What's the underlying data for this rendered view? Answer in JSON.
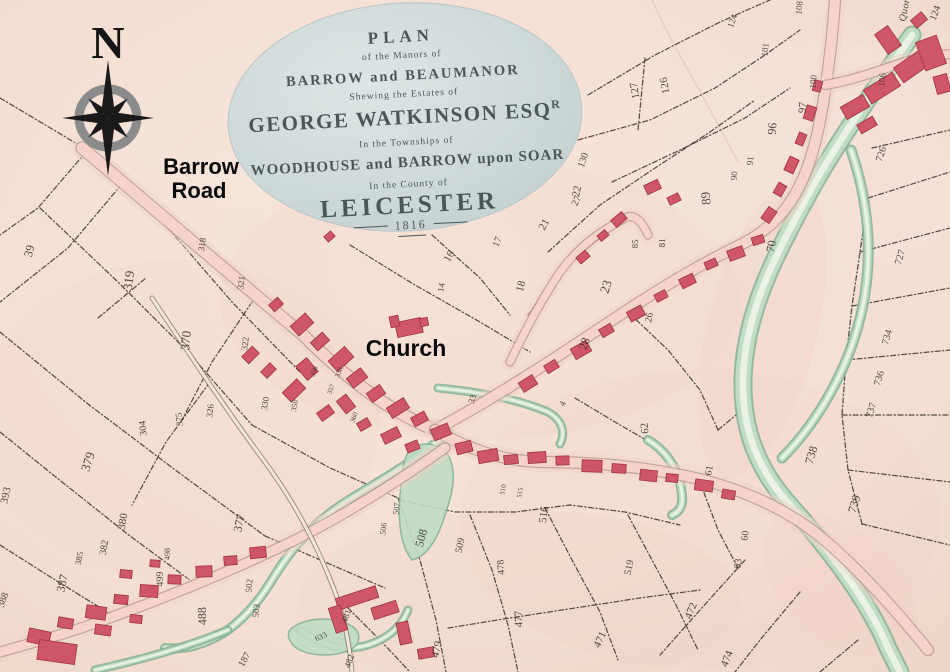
{
  "cartouche": {
    "plan": "PLAN",
    "of_manors": "of the Manors of",
    "barrow_beaumanor": "BARROW and BEAUMANOR",
    "shewing": "Shewing the Estates of",
    "owner": "GEORGE WATKINSON ESQ",
    "owner_sup": "R",
    "townships": "In the Townships of",
    "woodhouse_line": "WOODHOUSE and BARROW upon SOAR",
    "county": "In the County of",
    "leicester": "LEICESTER",
    "year": "1816"
  },
  "annotations": {
    "north": "N",
    "road_line1": "Barrow",
    "road_line2": "Road",
    "church": "Church",
    "quorn": "Quorn"
  },
  "colors": {
    "paper": "#f4e0d6",
    "road_fill": "#f5d3ca",
    "road_edge": "#b2938a",
    "lane_fill": "#f3e6da",
    "lane_edge": "#7c6c60",
    "building": "#cf5666",
    "building_edge": "#9e3344",
    "water_dark": "#85b296",
    "water_mid": "#c0dcc5",
    "water_light": "#e9f2e4",
    "boundary": "#332d26",
    "cartouche_fill": "#ccd8d9",
    "cartouche_text": "#4b565a",
    "compass_gray": "#8b8b8b",
    "label": "#0a0a0a"
  },
  "waterways": [
    {
      "d": "M912,35 C878,85 838,140 808,195 C778,250 752,300 745,355 C738,408 748,458 788,503 C830,550 868,600 888,648 C895,662 898,668 900,672",
      "w": 15
    },
    {
      "d": "M851,150 C868,200 874,255 862,310 C850,365 820,420 782,458",
      "w": 7
    },
    {
      "d": "M448,432 C420,458 385,478 352,498 C315,520 292,548 275,575 C262,597 248,615 228,630 C205,645 185,650 165,648",
      "w": 6
    },
    {
      "d": "M95,670 C140,660 185,648 228,630",
      "w": 5
    },
    {
      "d": "M438,388 C480,392 520,400 548,412 C562,420 566,432 560,444",
      "w": 5
    },
    {
      "d": "M648,440 C668,452 680,472 682,495 C683,505 680,512 672,515",
      "w": 6
    },
    {
      "d": "M300,630 C320,645 345,652 368,645 C390,638 402,625 408,610",
      "w": 5
    }
  ],
  "water_areas": [
    {
      "d": "M408,452 C420,440 438,442 448,455 C458,472 452,495 445,515 C438,538 428,556 412,560 C400,545 398,520 400,495 C402,475 402,465 408,452 Z"
    },
    {
      "d": "M292,628 C305,618 330,616 348,624 C362,630 362,644 350,650 C332,658 305,656 294,646 C288,640 286,633 292,628 Z"
    }
  ],
  "roads": [
    {
      "d": "M82,148 C150,205 225,270 302,334 C340,372 385,410 435,430",
      "w": 11
    },
    {
      "d": "M435,430 C500,395 560,355 620,315 C665,285 705,262 740,245 C770,230 788,210 800,185 C815,155 822,115 828,70 C832,40 834,15 835,0",
      "w": 10
    },
    {
      "d": "M825,85 C855,80 880,70 905,62 C925,57 940,55 950,54",
      "w": 8
    },
    {
      "d": "M510,362 C530,320 545,295 560,272 C580,245 600,232 625,218 C635,212 644,225 648,235",
      "w": 7
    },
    {
      "d": "M435,430 C470,450 505,462 545,462 C600,462 650,468 695,478 C745,490 788,510 822,538 C860,570 900,615 928,650",
      "w": 10
    },
    {
      "d": "M445,448 C400,480 350,512 295,540 C230,572 160,600 90,625 C55,637 25,645 0,652",
      "w": 9
    }
  ],
  "lanes": [
    {
      "d": "M152,298 C190,355 225,408 262,458 C295,502 320,550 338,600 C346,625 350,650 352,672",
      "w": 3
    }
  ],
  "boundaries": [
    "0,98 84,148",
    "86,152 38,208 0,235",
    "122,184 68,248 0,302",
    "40,208 118,282 188,352 252,425",
    "168,228 232,302 300,372",
    "0,332 88,404 178,472 265,536",
    "0,432 62,482 130,536 198,586",
    "0,545 52,578 112,615",
    "252,425 330,468 398,498",
    "265,536 325,562 385,588",
    "210,382 166,442 132,505",
    "252,302 212,362 182,420",
    "98,318 146,278",
    "588,95 655,55 720,22 770,0",
    "578,140 650,120 715,88 765,55 800,30",
    "612,182 680,150 745,118 790,88",
    "548,252 600,205 655,168 710,132 755,100",
    "528,315 560,270 600,238",
    "645,58 638,130",
    "628,312 668,350 700,390 718,430",
    "718,430 748,405",
    "575,398 620,425 660,448",
    "432,235 480,278 510,315",
    "350,245 415,285 480,322 530,352",
    "872,148 950,130",
    "868,198 950,172",
    "860,252 950,228",
    "852,306 950,288",
    "846,360 950,350",
    "842,415 950,415",
    "848,470 950,482",
    "862,524 950,545",
    "868,198 860,252 852,306 846,360 842,415 848,470 862,524",
    "745,560 700,610 660,655",
    "800,592 760,640 735,672",
    "858,640 820,672",
    "400,500 455,512 515,512 570,505 625,512 680,525",
    "398,498 420,560 436,620 446,672",
    "470,515 492,570 508,625 518,672",
    "545,508 572,560 600,612 618,660",
    "628,515 652,560 676,605 698,650",
    "700,482 718,530 738,568",
    "448,628 510,618 575,608 640,598 700,590",
    "340,600 380,640 410,672"
  ],
  "parcels": [
    [
      "39",
      33,
      252,
      -75,
      12
    ],
    [
      "319",
      133,
      281,
      -83,
      13
    ],
    [
      "318",
      205,
      245,
      -80,
      9
    ],
    [
      "370",
      190,
      341,
      -84,
      13
    ],
    [
      "321",
      244,
      283,
      -83,
      9
    ],
    [
      "304",
      146,
      428,
      -95,
      10
    ],
    [
      "375",
      182,
      419,
      -95,
      9
    ],
    [
      "322",
      248,
      344,
      -83,
      9
    ],
    [
      "326",
      213,
      411,
      -85,
      9
    ],
    [
      "330",
      268,
      404,
      -80,
      9
    ],
    [
      "379",
      92,
      463,
      -72,
      13
    ],
    [
      "393",
      9,
      496,
      -78,
      11
    ],
    [
      "388",
      6,
      601,
      -70,
      10
    ],
    [
      "387",
      66,
      584,
      -78,
      12
    ],
    [
      "385",
      82,
      559,
      -78,
      9
    ],
    [
      "382",
      107,
      548,
      -80,
      10
    ],
    [
      "380",
      126,
      522,
      -80,
      11
    ],
    [
      "377",
      243,
      524,
      -76,
      12
    ],
    [
      "498",
      170,
      554,
      -90,
      8
    ],
    [
      "499",
      163,
      579,
      -92,
      10
    ],
    [
      "488",
      206,
      616,
      -92,
      12
    ],
    [
      "502",
      252,
      586,
      -85,
      9
    ],
    [
      "503",
      259,
      611,
      -85,
      9
    ],
    [
      "187",
      247,
      661,
      -60,
      10
    ],
    [
      "633",
      322,
      639,
      -25,
      8
    ],
    [
      "481",
      349,
      617,
      -72,
      9
    ],
    [
      "482",
      352,
      662,
      -72,
      9
    ],
    [
      "479",
      440,
      650,
      -78,
      11
    ],
    [
      "477",
      522,
      619,
      -92,
      11
    ],
    [
      "478",
      504,
      567,
      -95,
      10
    ],
    [
      "471",
      603,
      641,
      -65,
      11
    ],
    [
      "474",
      730,
      660,
      -68,
      11
    ],
    [
      "472",
      694,
      612,
      -68,
      11
    ],
    [
      "508",
      425,
      539,
      -75,
      12
    ],
    [
      "509",
      463,
      546,
      -78,
      10
    ],
    [
      "506",
      386,
      529,
      -83,
      8
    ],
    [
      "507",
      399,
      509,
      -83,
      8
    ],
    [
      "516",
      547,
      515,
      -83,
      11
    ],
    [
      "519",
      632,
      568,
      -78,
      10
    ],
    [
      "62",
      648,
      428,
      -95,
      11
    ],
    [
      "63",
      741,
      564,
      -83,
      10
    ],
    [
      "60",
      748,
      536,
      -83,
      10
    ],
    [
      "61",
      712,
      471,
      -80,
      10
    ],
    [
      "738",
      815,
      456,
      -74,
      12
    ],
    [
      "739",
      858,
      505,
      -74,
      12
    ],
    [
      "736",
      882,
      379,
      -74,
      10
    ],
    [
      "737",
      874,
      411,
      -74,
      10
    ],
    [
      "734",
      890,
      338,
      -74,
      10
    ],
    [
      "727",
      903,
      258,
      -74,
      10
    ],
    [
      "726",
      884,
      155,
      -72,
      10
    ],
    [
      "70",
      775,
      247,
      -80,
      12
    ],
    [
      "89",
      710,
      198,
      -95,
      13
    ],
    [
      "96",
      776,
      129,
      -85,
      12
    ],
    [
      "97",
      806,
      108,
      -85,
      11
    ],
    [
      "91",
      753,
      161,
      -85,
      9
    ],
    [
      "90",
      737,
      176,
      -85,
      9
    ],
    [
      "100",
      816,
      82,
      -85,
      9
    ],
    [
      "101",
      768,
      50,
      -85,
      9
    ],
    [
      "108",
      802,
      8,
      -85,
      9
    ],
    [
      "106",
      885,
      80,
      -85,
      9
    ],
    [
      "124",
      938,
      14,
      -70,
      10
    ],
    [
      "124",
      735,
      22,
      -70,
      9
    ],
    [
      "127",
      638,
      90,
      -100,
      11
    ],
    [
      "126",
      668,
      85,
      -100,
      11
    ],
    [
      "128",
      572,
      80,
      -85,
      9
    ],
    [
      "130",
      586,
      161,
      -72,
      10
    ],
    [
      "22",
      580,
      192,
      -78,
      11
    ],
    [
      "23",
      610,
      288,
      -72,
      13
    ],
    [
      "81",
      665,
      243,
      -88,
      9
    ],
    [
      "85",
      638,
      244,
      -88,
      9
    ],
    [
      "26",
      652,
      318,
      -80,
      10
    ],
    [
      "16",
      452,
      258,
      -60,
      11
    ],
    [
      "17",
      500,
      243,
      -68,
      10
    ],
    [
      "21",
      547,
      226,
      -62,
      11
    ],
    [
      "27",
      579,
      202,
      -65,
      10
    ],
    [
      "18",
      524,
      287,
      -75,
      11
    ],
    [
      "28",
      588,
      345,
      -70,
      12
    ],
    [
      "14",
      444,
      288,
      -80,
      9
    ],
    [
      "33",
      475,
      400,
      -70,
      9
    ],
    [
      "4",
      565,
      405,
      -60,
      9
    ],
    [
      "357",
      333,
      390,
      -70,
      7
    ],
    [
      "338",
      341,
      373,
      -70,
      7
    ],
    [
      "356",
      316,
      372,
      -70,
      7
    ],
    [
      "360",
      356,
      418,
      -70,
      7
    ],
    [
      "350",
      297,
      406,
      -78,
      8
    ],
    [
      "510",
      505,
      490,
      -80,
      7
    ],
    [
      "515",
      522,
      493,
      -80,
      7
    ]
  ],
  "buildings": [
    [
      292,
      318,
      20,
      13,
      -42
    ],
    [
      312,
      336,
      16,
      11,
      -42
    ],
    [
      270,
      300,
      12,
      9,
      -42
    ],
    [
      330,
      352,
      22,
      14,
      -42
    ],
    [
      300,
      360,
      14,
      18,
      -40
    ],
    [
      348,
      372,
      18,
      12,
      -38
    ],
    [
      368,
      388,
      16,
      11,
      -35
    ],
    [
      340,
      396,
      12,
      16,
      -38
    ],
    [
      388,
      402,
      20,
      12,
      -32
    ],
    [
      412,
      414,
      15,
      10,
      -28
    ],
    [
      432,
      426,
      18,
      12,
      -22
    ],
    [
      284,
      384,
      20,
      13,
      -44
    ],
    [
      262,
      366,
      13,
      9,
      -45
    ],
    [
      243,
      350,
      15,
      10,
      -45
    ],
    [
      318,
      408,
      15,
      10,
      -36
    ],
    [
      358,
      420,
      12,
      9,
      -30
    ],
    [
      382,
      430,
      18,
      11,
      -26
    ],
    [
      406,
      442,
      13,
      9,
      -22
    ],
    [
      396,
      320,
      26,
      15,
      -12
    ],
    [
      390,
      316,
      9,
      11,
      -12
    ],
    [
      420,
      318,
      8,
      8,
      -12
    ],
    [
      456,
      442,
      16,
      11,
      -14
    ],
    [
      478,
      450,
      20,
      12,
      -10
    ],
    [
      504,
      455,
      14,
      9,
      -6
    ],
    [
      528,
      452,
      18,
      11,
      -4
    ],
    [
      556,
      456,
      13,
      9,
      -2
    ],
    [
      582,
      460,
      20,
      12,
      2
    ],
    [
      612,
      464,
      14,
      9,
      4
    ],
    [
      640,
      470,
      17,
      11,
      6
    ],
    [
      666,
      474,
      12,
      8,
      6
    ],
    [
      695,
      480,
      18,
      11,
      8
    ],
    [
      722,
      490,
      13,
      9,
      10
    ],
    [
      520,
      378,
      16,
      11,
      -32
    ],
    [
      545,
      362,
      13,
      9,
      -32
    ],
    [
      572,
      344,
      18,
      12,
      -30
    ],
    [
      600,
      326,
      13,
      9,
      -30
    ],
    [
      628,
      308,
      16,
      11,
      -28
    ],
    [
      655,
      292,
      12,
      8,
      -28
    ],
    [
      680,
      276,
      15,
      10,
      -26
    ],
    [
      705,
      260,
      12,
      8,
      -24
    ],
    [
      728,
      248,
      16,
      11,
      -20
    ],
    [
      752,
      236,
      12,
      8,
      -18
    ],
    [
      762,
      210,
      14,
      10,
      -55
    ],
    [
      774,
      185,
      12,
      9,
      -60
    ],
    [
      784,
      160,
      15,
      10,
      -65
    ],
    [
      795,
      135,
      12,
      8,
      -68
    ],
    [
      803,
      108,
      14,
      10,
      -72
    ],
    [
      812,
      82,
      11,
      8,
      -75
    ],
    [
      842,
      100,
      26,
      14,
      -30
    ],
    [
      865,
      80,
      34,
      16,
      -32
    ],
    [
      895,
      55,
      40,
      18,
      -35
    ],
    [
      880,
      28,
      16,
      24,
      -35
    ],
    [
      920,
      38,
      22,
      30,
      -20
    ],
    [
      935,
      75,
      14,
      18,
      -15
    ],
    [
      858,
      120,
      18,
      10,
      -30
    ],
    [
      912,
      15,
      14,
      10,
      -40
    ],
    [
      645,
      182,
      15,
      10,
      -25
    ],
    [
      668,
      195,
      12,
      8,
      -25
    ],
    [
      577,
      253,
      12,
      8,
      -40
    ],
    [
      612,
      215,
      14,
      9,
      -40
    ],
    [
      598,
      232,
      10,
      7,
      -40
    ],
    [
      28,
      630,
      22,
      14,
      12
    ],
    [
      58,
      618,
      15,
      10,
      10
    ],
    [
      86,
      606,
      20,
      13,
      8
    ],
    [
      114,
      595,
      14,
      9,
      6
    ],
    [
      140,
      585,
      18,
      12,
      4
    ],
    [
      168,
      575,
      13,
      9,
      2
    ],
    [
      196,
      566,
      16,
      11,
      -2
    ],
    [
      224,
      556,
      13,
      9,
      -4
    ],
    [
      250,
      547,
      16,
      11,
      -6
    ],
    [
      120,
      570,
      12,
      8,
      6
    ],
    [
      150,
      560,
      10,
      7,
      4
    ],
    [
      38,
      642,
      38,
      20,
      8
    ],
    [
      95,
      625,
      16,
      10,
      8
    ],
    [
      130,
      615,
      12,
      8,
      6
    ],
    [
      336,
      592,
      42,
      12,
      -18
    ],
    [
      332,
      606,
      12,
      26,
      -18
    ],
    [
      372,
      604,
      26,
      12,
      -18
    ],
    [
      398,
      622,
      12,
      22,
      -12
    ],
    [
      418,
      648,
      16,
      10,
      -10
    ],
    [
      325,
      233,
      9,
      7,
      -42
    ]
  ]
}
